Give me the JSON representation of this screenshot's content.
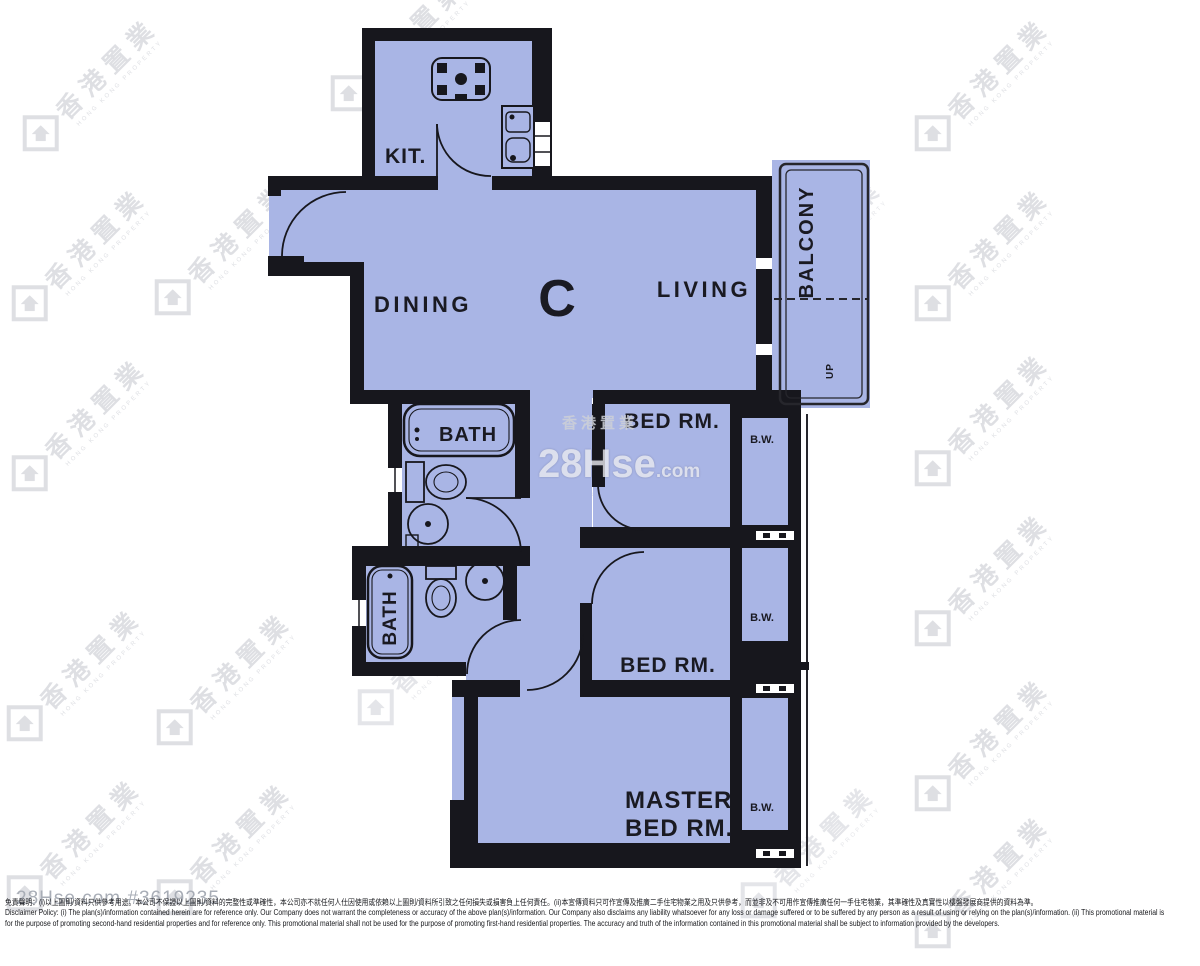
{
  "plan": {
    "unit_label": "C",
    "labels": {
      "kitchen": "KIT.",
      "dining": "DINING",
      "living": "LIVING",
      "balcony": "BALCONY",
      "up": "UP",
      "bath_upper": "BATH",
      "bath_lower": "BATH",
      "bedroom_upper": "BED RM.",
      "bedroom_lower": "BED RM.",
      "master_line1": "MASTER",
      "master_line2": "BED RM.",
      "bay_window_1": "B.W.",
      "bay_window_2": "B.W.",
      "bay_window_3": "B.W."
    },
    "colors": {
      "room_fill": "#a9b5e5",
      "wall": "#17171d"
    }
  },
  "watermarks": {
    "brand_cn": "香港置業",
    "brand_en": "HONG KONG PROPERTY",
    "site_main": "28Hse",
    "site_suffix": ".com"
  },
  "footer": {
    "ref": "28Hse.com #3619235",
    "disclaimer_cn": "免責聲明：(i)以上圖則/資料只供參考用途。本公司不保證以上圖則/資料的完整性或準確性，本公司亦不就任何人仕因使用或依賴以上圖則/資料所引致之任何損失或損害負上任何責任。(ii)本宣傳資料只可作宣傳及推廣二手住宅物業之用及只供參考，而並非及不可用作宣傳推廣任何一手住宅物業，其準確性及真實性以樓盤發展商提供的資料為準。",
    "disclaimer_en_1": "Disclaimer Policy: (i) The plan(s)/information contained herein are for reference only. Our Company does not warrant the completeness or accuracy of the above plan(s)/information. Our Company also disclaims any liability whatsoever for any loss or damage suffered or to be suffered by any person as a result of using or relying on the plan(s)/information. (ii) This promotional material is",
    "disclaimer_en_2": "for the purpose of promoting second-hand residential properties and for reference only. This promotional material shall not be used for the purpose of promoting first-hand residential properties. The accuracy and truth of the information contained in this promotional material shall be subject to information provided by the developers."
  }
}
